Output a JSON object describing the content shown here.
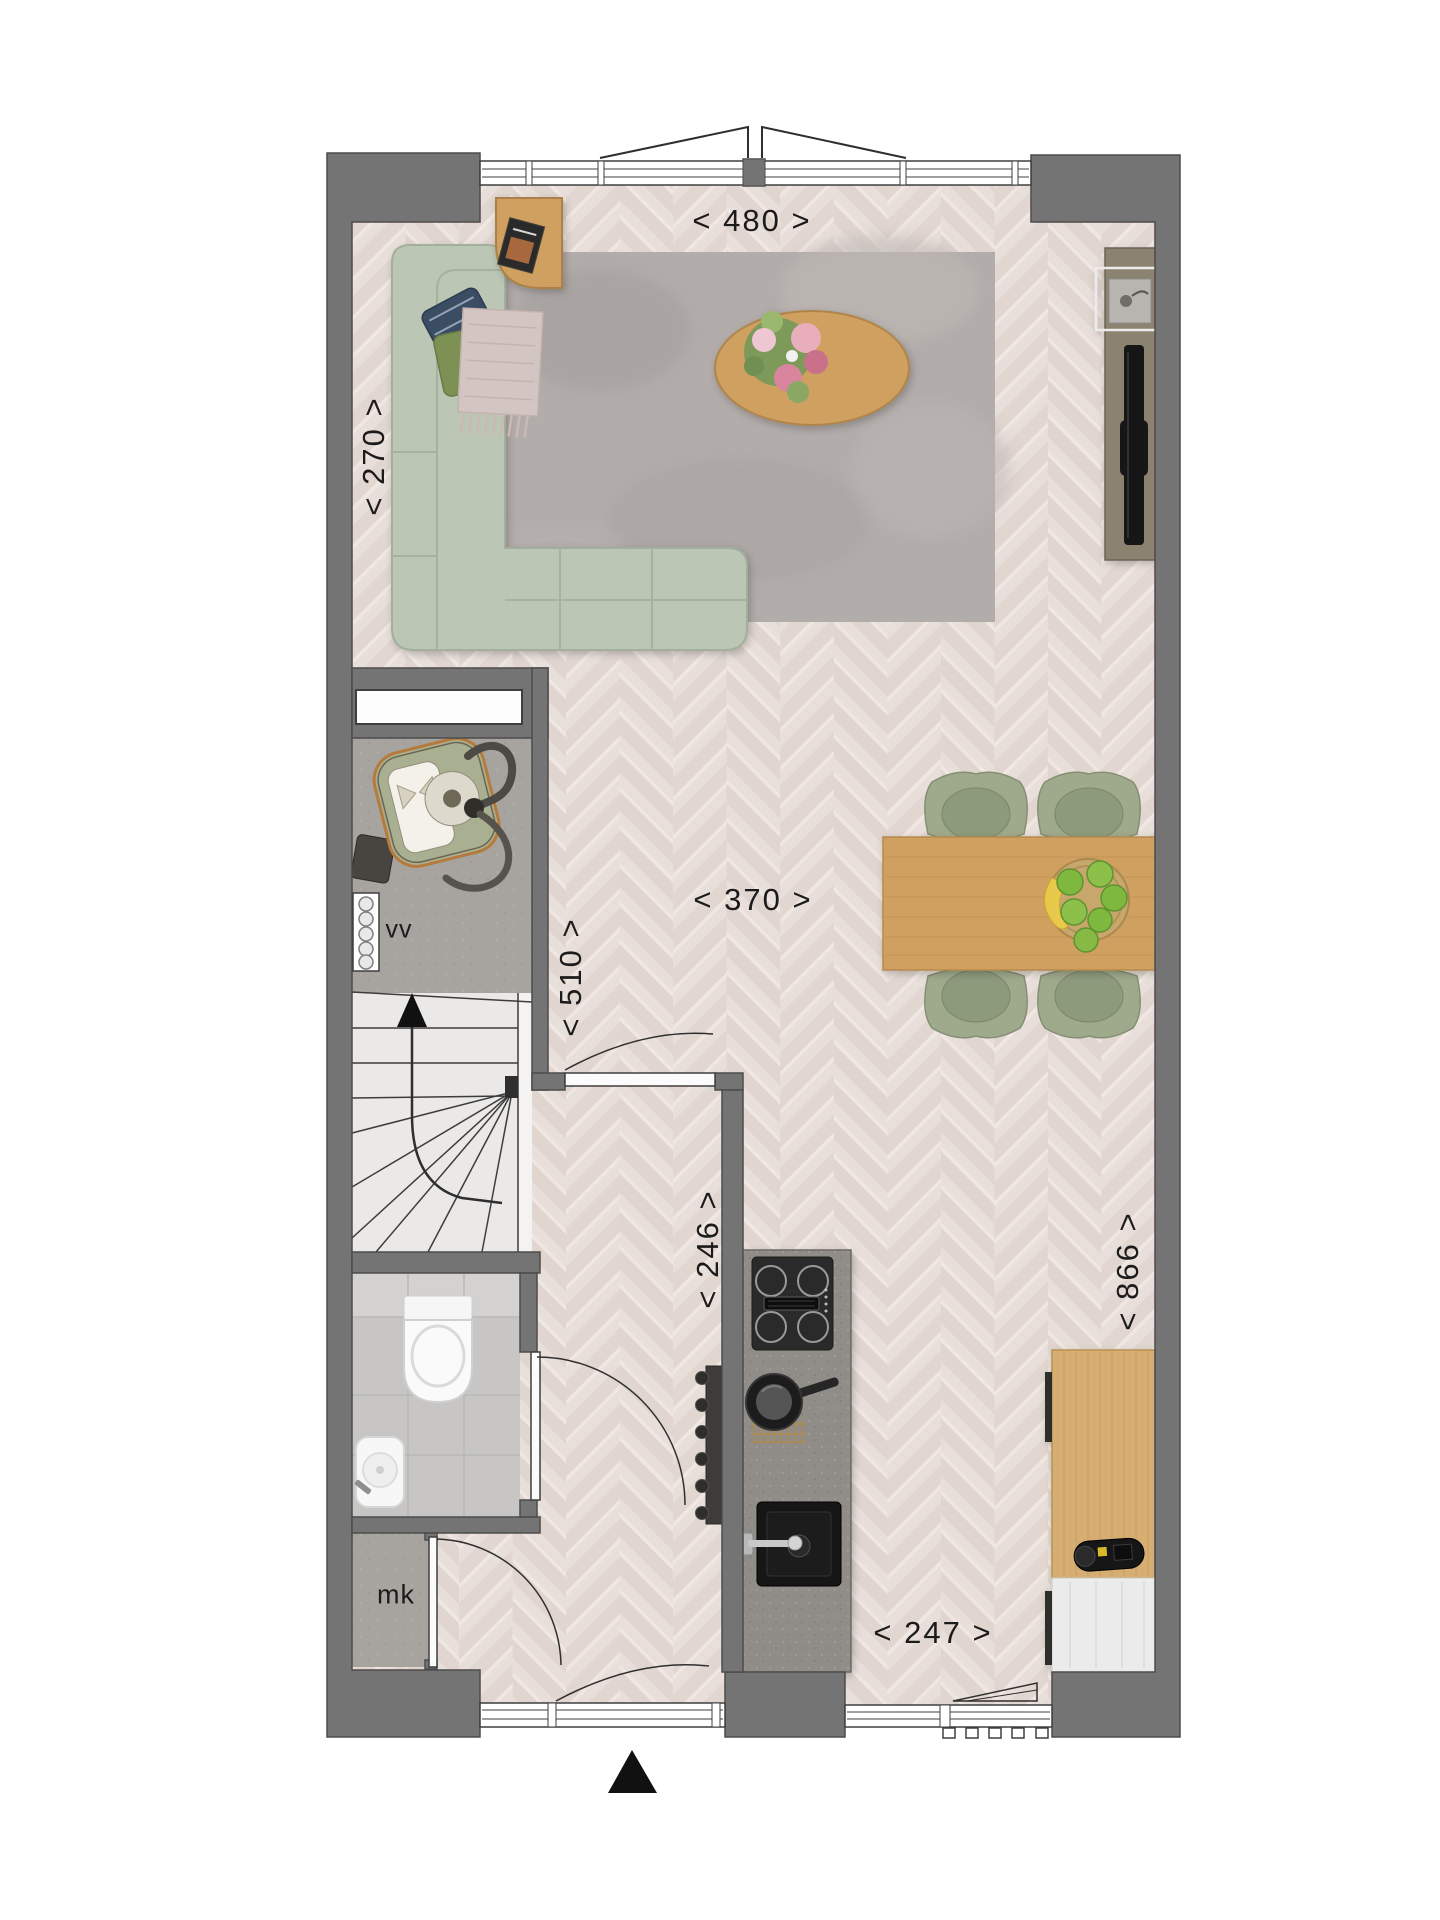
{
  "floorplan": {
    "dimension_labels": {
      "top_width": "< 480 >",
      "left_height": "< 270 >",
      "living_width": "< 370 >",
      "hall_height": "< 510 >",
      "kitchen_width": "< 246 >",
      "right_depth": "< 866 >",
      "bottom_width": "< 247 >"
    },
    "room_labels": {
      "heating_manifold": "vv",
      "meter_cupboard": "mk"
    },
    "colors": {
      "wall": "#747474",
      "parquet": "#e8ded9",
      "rug": "#b2acaa",
      "sofa": "#bcc6b4",
      "wood": "#cfa05f",
      "chair": "#9fa98b",
      "island": "#908d88",
      "concrete": "#a7a4a0",
      "stairs": "#ebe9e7",
      "tile": "#c7c6c4",
      "north_arrow": "#111111"
    }
  }
}
